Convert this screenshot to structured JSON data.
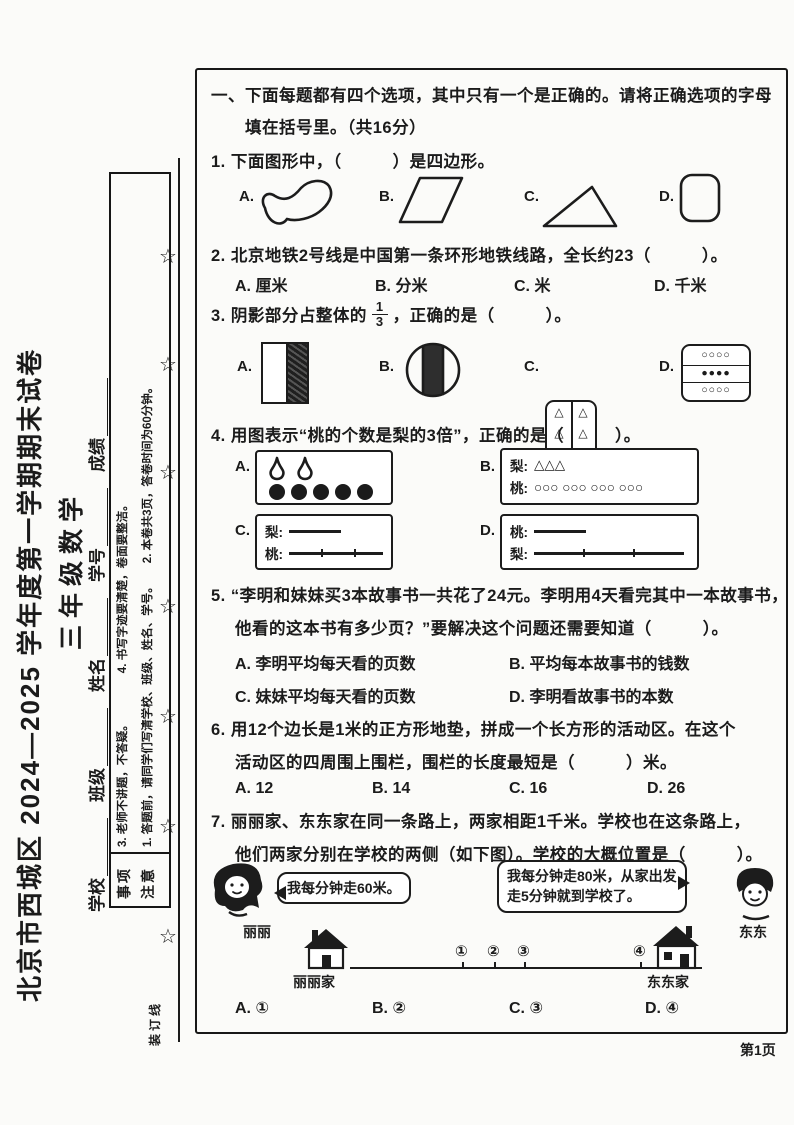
{
  "paper": {
    "title": "北京市西城区 2024—2025 学年度第一学期期末试卷",
    "subtitle": "三年级数学",
    "fields": {
      "school": "学校",
      "clazz": "班级",
      "name": "姓名",
      "student_id": "学号",
      "score": "成绩"
    },
    "notice": {
      "label_line1": "注意",
      "label_line2": "事项",
      "item1": "1. 答题前，请同学们写清学校、班级、姓名、学号。",
      "item2": "2. 本卷共3页，答卷时间为60分钟。",
      "item3": "3. 老师不讲题，不答疑。",
      "item4": "4. 书写字迹要清楚，卷面要整洁。"
    },
    "binding_label": "装订线",
    "star_glyph": "☆",
    "page_label": "第1页"
  },
  "section_one": {
    "header_line1": "一、下面每题都有四个选项，其中只有一个是正确的。请将正确选项的字母",
    "header_line2": "填在括号里。（共16分）"
  },
  "q1": {
    "text": "1. 下面图形中，（　　　）是四边形。",
    "label_a": "A.",
    "label_b": "B.",
    "label_c": "C.",
    "label_d": "D."
  },
  "q2": {
    "text": "2. 北京地铁2号线是中国第一条环形地铁线路，全长约23（　　　）。",
    "opt_a": "A. 厘米",
    "opt_b": "B. 分米",
    "opt_c": "C. 米",
    "opt_d": "D. 千米"
  },
  "q3": {
    "text_pre": "3. 阴影部分占整体的",
    "frac_num": "1",
    "frac_den": "3",
    "text_post": "，正确的是（　　　）。",
    "label_a": "A.",
    "label_b": "B.",
    "label_c": "C.",
    "label_d": "D.",
    "triangle_glyph": "△",
    "d_row1": "○○○○",
    "d_row2": "●●●●",
    "d_row3": "○○○○"
  },
  "q4": {
    "text": "4. 用图表示“桃的个数是梨的3倍”，正确的是（　　　）。",
    "label_a": "A.",
    "label_b": "B.",
    "label_c": "C.",
    "label_d": "D.",
    "pear_label": "梨:",
    "peach_label": "桃:",
    "b_pears": "△△△",
    "b_peaches": "○○○ ○○○ ○○○ ○○○"
  },
  "q5": {
    "line1": "5. “李明和妹妹买3本故事书一共花了24元。李明用4天看完其中一本故事书，",
    "line2": "他看的这本书有多少页？”要解决这个问题还需要知道（　　　）。",
    "opt_a": "A. 李明平均每天看的页数",
    "opt_b": "B. 平均每本故事书的钱数",
    "opt_c": "C. 妹妹平均每天看的页数",
    "opt_d": "D. 李明看故事书的本数"
  },
  "q6": {
    "line1": "6. 用12个边长是1米的正方形地垫，拼成一个长方形的活动区。在这个",
    "line2": "活动区的四周围上围栏，围栏的长度最短是（　　　）米。",
    "opt_a": "A. 12",
    "opt_b": "B. 14",
    "opt_c": "C. 16",
    "opt_d": "D. 26"
  },
  "q7": {
    "line1": "7. 丽丽家、东东家在同一条路上，两家相距1千米。学校也在这条路上，",
    "line2": "他们两家分别在学校的两侧（如下图）。学校的大概位置是（　　　）。",
    "girl_name": "丽丽",
    "boy_name": "东东",
    "girl_bubble": "我每分钟走60米。",
    "boy_bubble_line1": "我每分钟走80米，从家出发",
    "boy_bubble_line2": "走5分钟就到学校了。",
    "left_house_label": "丽丽家",
    "right_house_label": "东东家",
    "p1": "①",
    "p2": "②",
    "p3": "③",
    "p4": "④",
    "opt_a": "A. ①",
    "opt_b": "B. ②",
    "opt_c": "C. ③",
    "opt_d": "D. ④"
  }
}
